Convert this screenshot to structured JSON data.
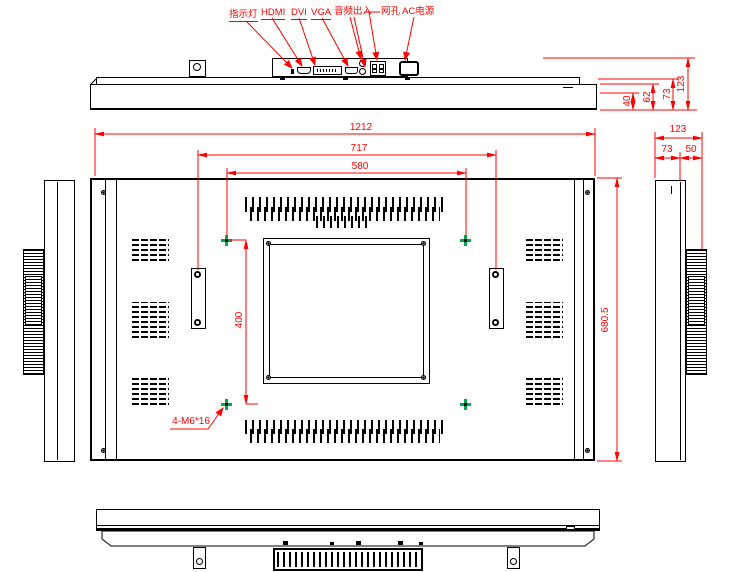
{
  "drawing": {
    "title": "industrial monitor outline drawing",
    "colors": {
      "line": "#000000",
      "dimension": "#ff0000",
      "vesa_marker": "#00a651",
      "background": "#ffffff"
    }
  },
  "top_view": {
    "callouts": [
      {
        "label": "指示灯"
      },
      {
        "label": "HDMI"
      },
      {
        "label": "DVI"
      },
      {
        "label": "VGA"
      },
      {
        "label": "音频出入"
      },
      {
        "label": "网孔"
      },
      {
        "label": "AC电源"
      }
    ],
    "dims": {
      "step1": "40",
      "step2": "62",
      "step3": "73",
      "depth": "123"
    }
  },
  "rear_view": {
    "dims": {
      "overall_width": "1212",
      "handle_spacing": "717",
      "vesa_width": "580",
      "vesa_height": "400",
      "overall_height": "680.5"
    },
    "vesa_hole_note": "4-M6*16"
  },
  "right_side_view": {
    "dims": {
      "overall_depth": "123",
      "body_depth": "73",
      "vent_depth": "50"
    }
  }
}
